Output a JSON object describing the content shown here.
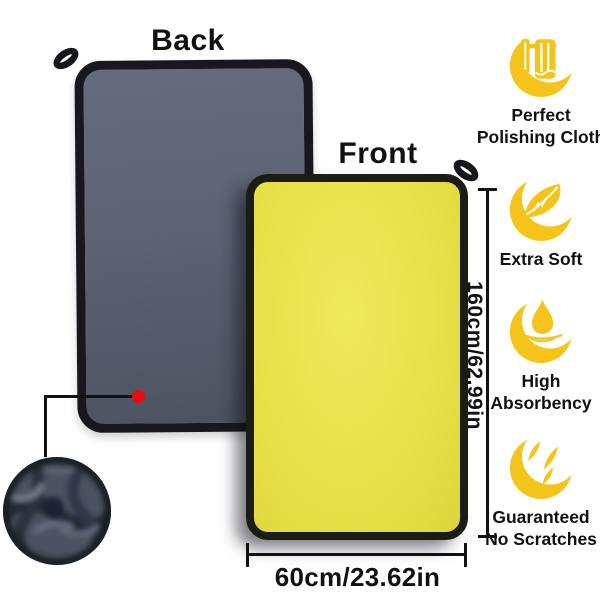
{
  "labels": {
    "back": "Back",
    "front": "Front"
  },
  "dimensions": {
    "height": "160cm/62.99in",
    "width": "60cm/23.62in"
  },
  "features": [
    {
      "icon": "polishing-towel-icon",
      "line1": "Perfect",
      "line2": "Polishing Cloth"
    },
    {
      "icon": "feather-icon",
      "line1": "Extra Soft",
      "line2": ""
    },
    {
      "icon": "water-drop-icon",
      "line1": "High",
      "line2": "Absorbency"
    },
    {
      "icon": "scratch-marks-icon",
      "line1": "Guaranteed",
      "line2": "No Scratches"
    }
  ],
  "colors": {
    "background": "#ffffff",
    "towel_back_gray": "#5d6373",
    "towel_front_yellow": "#e8e14a",
    "trim_black": "#17181d",
    "feature_icon_yellow": "#f5c41b",
    "marker_red": "#ea0a12",
    "text_black": "#111111"
  }
}
